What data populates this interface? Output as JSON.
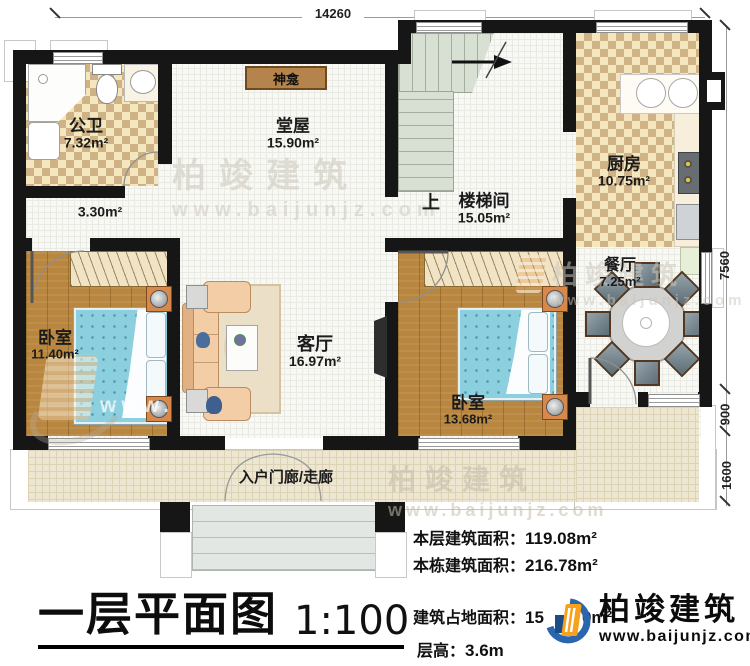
{
  "plan": {
    "dim_top": "14260",
    "dims_right": [
      "7560",
      "900",
      "1600"
    ],
    "rooms": {
      "bathroom": {
        "name": "公卫",
        "area": "7.32m²"
      },
      "corridor": {
        "area": "3.30m²"
      },
      "hall": {
        "name": "堂屋",
        "area": "15.90m²"
      },
      "altar": {
        "name": "神龛"
      },
      "stairwell": {
        "name": "楼梯间",
        "area": "15.05m²",
        "up": "上"
      },
      "kitchen": {
        "name": "厨房",
        "area": "10.75m²"
      },
      "dining": {
        "name": "餐厅",
        "area": "7.25m²"
      },
      "bedroom_left": {
        "name": "卧室",
        "area": "11.40m²"
      },
      "living": {
        "name": "客厅",
        "area": "16.97m²"
      },
      "bedroom_right": {
        "name": "卧室",
        "area": "13.68m²"
      },
      "porch": {
        "name": "入户门廊/走廊"
      }
    }
  },
  "title": {
    "text": "一层平面图",
    "scale": "1:100"
  },
  "stats": {
    "floor_area_label": "本层建筑面积：",
    "floor_area_value": "119.08m²",
    "building_area_label": "本栋建筑面积：",
    "building_area_value": "216.78m²",
    "footprint_label": "建筑占地面积：",
    "footprint_value_visible": "15",
    "footprint_value_tail": "0m²",
    "height_label": "层高：",
    "height_value": "3.6m"
  },
  "logo": {
    "name": "柏竣建筑",
    "url": "www.baijunjz.com"
  },
  "watermark": {
    "brand": "柏竣建筑",
    "url": "www.baijunjz.com",
    "short": "www."
  },
  "colors": {
    "wall": "#161616",
    "checker_tile": "#cfb285",
    "wood_floor": "#b8863e",
    "bed_blue": "#8ccfdf",
    "porch_tile": "#ede6d1",
    "altar_brown": "#b5834c",
    "logo_orange": "#f7a11c",
    "logo_blue": "#2a66ae"
  }
}
